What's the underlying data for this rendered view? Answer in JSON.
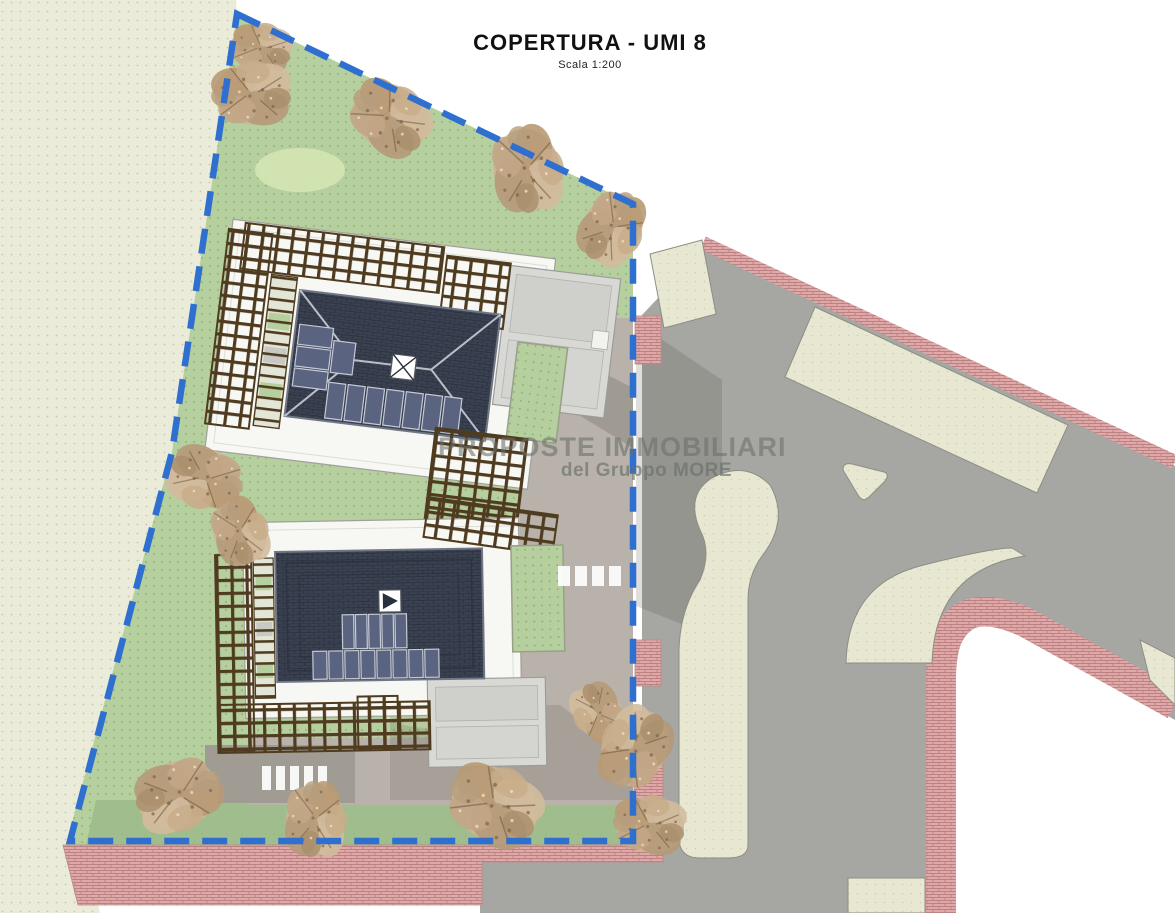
{
  "header": {
    "title": "COPERTURA - UMI 8",
    "scale_label": "Scala 1:200"
  },
  "watermark": {
    "line_1": "PROPOSTE IMMOBILIARI",
    "line_2": "del Gruppo MORE"
  },
  "colors": {
    "boundary_blue": "#2e6fd0",
    "lawn_green": "#b6cf9e",
    "lawn_dot": "#8aa96c",
    "lawn_dark": "#9cba8a",
    "lawn_light": "#d4e4b2",
    "outside_ground": "#eaebd8",
    "outside_dot": "#c7c9b2",
    "road_gray": "#a6a6a2",
    "driveway_gray": "#b8b2aa",
    "driveway_dark": "#a19c93",
    "sidewalk_pink": "#dfa9a9",
    "brick_line": "#bd8181",
    "island_beige": "#e8e8d2",
    "island_dot": "#ccccae",
    "roof_dark": "#3a4150",
    "roof_line": "#2a303d",
    "roof_ridge": "#c9cdd6",
    "solar_panel": "#5a6480",
    "solar_frame": "#c6cad6",
    "pergola_brown": "#4f3c20",
    "platform_white": "#f7f7f4",
    "annex_gray": "#d8d8d5",
    "tree_tan": "#c4ab88",
    "tree_dark": "#8d775a",
    "shadow": "#4a4741"
  }
}
